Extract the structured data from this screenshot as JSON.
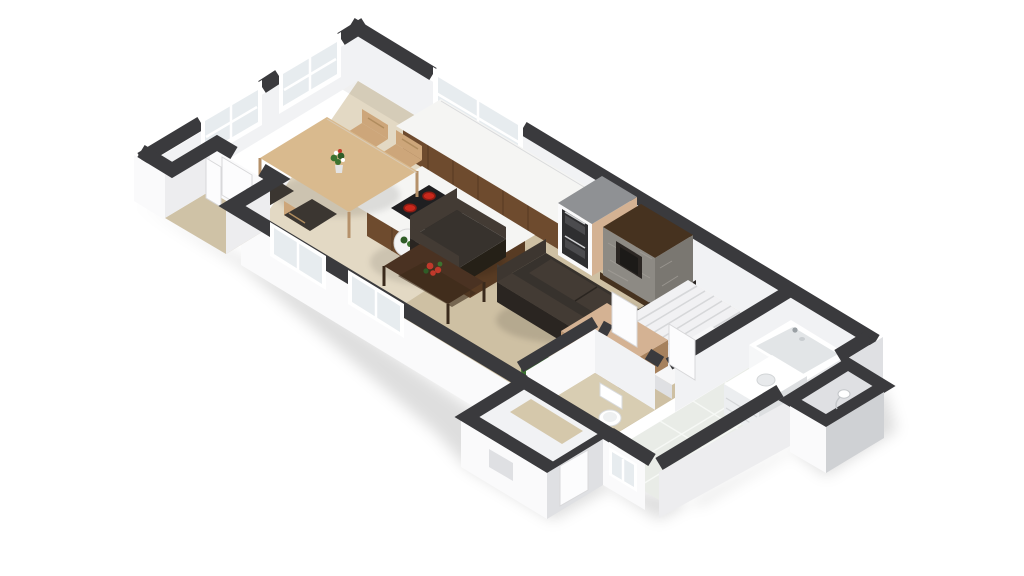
{
  "scene": {
    "name": "3d-floor-plan-isometric",
    "view": "isometric-cutaway",
    "level": "ground-floor"
  },
  "rooms": [
    {
      "name": "kitchen-dining",
      "floor": "light-wood"
    },
    {
      "name": "living-room",
      "floor": "light-wood"
    },
    {
      "name": "entry-alcove",
      "floor": "light-wood"
    },
    {
      "name": "hallway",
      "floor": "light-wood"
    },
    {
      "name": "staircase",
      "floor": "white-stairs"
    },
    {
      "name": "wc",
      "floor": "light-wood"
    },
    {
      "name": "bathroom",
      "floor": "gray-tile"
    },
    {
      "name": "side-porch",
      "floor": "light-wood"
    },
    {
      "name": "storage-closet",
      "floor": "gray"
    }
  ],
  "furniture": [
    {
      "name": "kitchen-counter"
    },
    {
      "name": "oven-tower"
    },
    {
      "name": "kitchen-island-with-cooktop-and-sink"
    },
    {
      "name": "fireplace"
    },
    {
      "name": "dining-table"
    },
    {
      "name": "dining-chair",
      "count": 4
    },
    {
      "name": "flower-vase"
    },
    {
      "name": "side-table-lamp"
    },
    {
      "name": "armchair"
    },
    {
      "name": "coffee-table-with-flowers"
    },
    {
      "name": "sofa"
    },
    {
      "name": "potted-plant"
    },
    {
      "name": "stairs-with-landing"
    },
    {
      "name": "stair-cabinet"
    },
    {
      "name": "bathtub"
    },
    {
      "name": "bathroom-vanity"
    },
    {
      "name": "toilet"
    },
    {
      "name": "wall-fixture"
    }
  ],
  "openings": [
    {
      "name": "window",
      "wall": "north-end",
      "count": 2
    },
    {
      "name": "window",
      "wall": "north-east",
      "count": 1
    },
    {
      "name": "window",
      "wall": "south-west",
      "count": 2
    },
    {
      "name": "window",
      "wall": "bathroom-south",
      "count": 1
    },
    {
      "name": "entry-door"
    },
    {
      "name": "porch-door"
    },
    {
      "name": "wc-door"
    },
    {
      "name": "bathroom-door"
    }
  ],
  "colors": {
    "bg": "#ffffff",
    "wallTop": "#3a3a3d",
    "faceLight": "#fafafb",
    "faceMid": "#ededef",
    "faceDark": "#dfe0e3",
    "faceDarker": "#cfd1d4",
    "interiorFace": "#f1f2f4",
    "floorMain": "#d8cbae",
    "floorBath": "#e9ece7",
    "floorWc": "#d8cdb2",
    "grout": "#f7f9f6",
    "counterTop": "#f5f5f3",
    "woodMid": "#6e4b2e",
    "woodDark": "#583b23",
    "woodTable": "#d9ba8e",
    "woodChair": "#cda67a",
    "chairDark": "#3b3631",
    "woodCabTop": "#d4b293",
    "woodCabFace": "#ba936f",
    "woodCabSide": "#a6815d",
    "sofa": "#37322d",
    "sofaBack": "#433b34",
    "sofaDark": "#2a2521",
    "stone": "#8d8a84",
    "stoneSide": "#7a7771",
    "mantel": "#46321f",
    "firebox": "#2b2623",
    "stairs": "#f1f1f3",
    "stairLine": "#d6d7d9",
    "landing": "#f7f7f8",
    "white": "#ffffff",
    "glass": "#e7ecef",
    "steel": "#8f9194",
    "ovenDark": "#2e2e30",
    "ovenGlass": "#4b4b4e",
    "burner": "#c9281c",
    "burnerDark": "#8e1b12",
    "sink": "#54575a",
    "sinkInner": "#3f4245",
    "plantDark": "#244a1e",
    "plantMid": "#2f5c27",
    "plantLight": "#3c7330",
    "flowerRed": "#c0392b",
    "tub": "#f6f7f8",
    "tubInner": "#e2e5e7",
    "doorWhite": "#fcfcfd",
    "doorFrame": "#d8d8da"
  }
}
